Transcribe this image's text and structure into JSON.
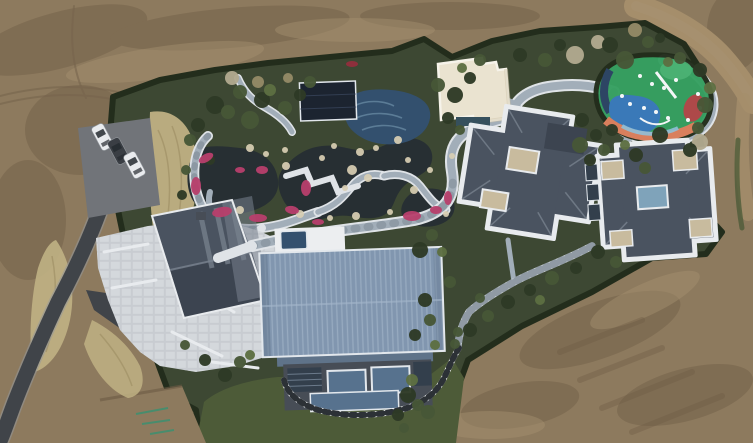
{
  "scene": {
    "kind": "aerial-drone-photo",
    "description": "Top-down aerial view of a landscaped private estate under construction: bare earth surrounds a hedged garden compound containing a koi pond garden with winding stone paths and pink azalea beds, a dark glass pavilion, a cream flat-roof pavilion, a colorful children's playground, two slate hip-roof villas with white parapets, a large blue standing-seam roof hall, a stone plaza with a gable-roof guest house, a parking pad with three cars and a curving asphalt road.",
    "objects": [
      "dirt ground",
      "dirt road",
      "hedge boundary",
      "garden grounds",
      "dry grass",
      "asphalt road",
      "parking pad",
      "3 cars",
      "stone plaza",
      "guest house",
      "pond",
      "flower beds",
      "rocks",
      "garden paths",
      "dark pavilion",
      "mosaic pool",
      "spa pool",
      "cream pavilion",
      "playground",
      "villa east",
      "villa far-east",
      "blue roof hall",
      "skylights",
      "checker path",
      "lawn",
      "shrubs",
      "bare trees"
    ]
  },
  "palette": {
    "dirt_base": "#8d7a5e",
    "dirt_dark": "#6d5a44",
    "dirt_light": "#a69270",
    "dirt_road": "#a58e6b",
    "dirt_track": "#77654e",
    "grass_dry": "#c0b184",
    "grass_dry_dark": "#9c8d62",
    "garden_base": "#3d4833",
    "hedge": "#232d1c",
    "lawn": "#4d5b38",
    "shrub_dark": "#2e3a26",
    "shrub_mid": "#475737",
    "shrub_light": "#5d6f42",
    "shrub_tan": "#948a67",
    "tree_bare": "#b1a98f",
    "water_dark": "#272f33",
    "pool_tile": "#33506e",
    "pool_wave": "#7da0b8",
    "path_light": "#dfe3e7",
    "path_mid": "#a2aeb9",
    "path_joint": "#76828d",
    "plaza": "#c8ccd1",
    "plaza_tile": "#eceef0",
    "rock": "#d9cfb4",
    "flower_pink": "#b83f6c",
    "flower_red": "#8e2f3c",
    "road_asphalt": "#404449",
    "road_edge": "#93989d",
    "parking": "#717479",
    "car_white": "#e9ebee",
    "car_dark": "#3a3e44",
    "car_glass": "#262b30",
    "roof_blue": "#8196af",
    "roof_blue_light": "#a3b5c9",
    "roof_blue_dark": "#5f7389",
    "wall_dark": "#474d56",
    "glass_blue": "#57728e",
    "glass_dark": "#333f4c",
    "glass_frame": "#e2e7ec",
    "roof_slate": "#4a5360",
    "roof_slate_dark": "#3c4450",
    "roof_slate_light": "#78828e",
    "parapet_white": "#e8ebee",
    "pad_tan": "#c8bb9e",
    "skylight": "#7fa3ba",
    "cream_roof": "#eae3d0",
    "cream_trim": "#f6f3ea",
    "cream_pool": "#36505d",
    "pavilion_dark": "#1c2430",
    "pavilion_line": "#38455b",
    "pg_green": "#36a061",
    "pg_green_light": "#4cb274",
    "pg_blue": "#3a79b8",
    "pg_orange": "#d97f5d",
    "pg_red": "#ae4949",
    "pg_navy": "#2d4564",
    "pg_light": "#8fc0d8",
    "white": "#f4f6f7",
    "spray_green": "#3d9070",
    "checker_dark": "#2c3136",
    "steps_light": "#ccd3d9"
  },
  "features": {
    "shrubs": [
      [
        215,
        105,
        9,
        "shrub_dark"
      ],
      [
        240,
        92,
        7,
        "shrub_mid"
      ],
      [
        262,
        100,
        8,
        "shrub_dark"
      ],
      [
        198,
        125,
        7,
        "shrub_dark"
      ],
      [
        228,
        112,
        7,
        "shrub_mid"
      ],
      [
        250,
        120,
        9,
        "shrub_mid"
      ],
      [
        285,
        108,
        7,
        "shrub_mid"
      ],
      [
        300,
        95,
        6,
        "shrub_dark"
      ],
      [
        310,
        82,
        6,
        "shrub_mid"
      ],
      [
        270,
        90,
        6,
        "shrub_light"
      ],
      [
        232,
        78,
        7,
        "tree_bare"
      ],
      [
        258,
        82,
        6,
        "shrub_tan"
      ],
      [
        288,
        78,
        5,
        "shrub_tan"
      ],
      [
        190,
        140,
        6,
        "shrub_mid"
      ],
      [
        210,
        160,
        5,
        "shrub_dark"
      ],
      [
        438,
        85,
        7,
        "shrub_mid"
      ],
      [
        455,
        95,
        8,
        "shrub_dark"
      ],
      [
        470,
        78,
        6,
        "shrub_dark"
      ],
      [
        462,
        68,
        5,
        "shrub_light"
      ],
      [
        480,
        60,
        6,
        "shrub_mid"
      ],
      [
        520,
        55,
        7,
        "shrub_dark"
      ],
      [
        545,
        60,
        7,
        "shrub_mid"
      ],
      [
        560,
        45,
        6,
        "shrub_dark"
      ],
      [
        575,
        55,
        9,
        "tree_bare"
      ],
      [
        598,
        42,
        7,
        "tree_bare"
      ],
      [
        610,
        45,
        8,
        "shrub_dark"
      ],
      [
        625,
        60,
        9,
        "shrub_mid"
      ],
      [
        635,
        30,
        7,
        "shrub_tan"
      ],
      [
        648,
        42,
        6,
        "shrub_mid"
      ],
      [
        660,
        38,
        5,
        "shrub_dark"
      ],
      [
        700,
        70,
        7,
        "shrub_dark"
      ],
      [
        705,
        105,
        8,
        "shrub_mid"
      ],
      [
        698,
        128,
        6,
        "shrub_mid"
      ],
      [
        710,
        88,
        6,
        "shrub_light"
      ],
      [
        700,
        142,
        8,
        "tree_bare"
      ],
      [
        680,
        58,
        6,
        "shrub_mid"
      ],
      [
        668,
        62,
        5,
        "shrub_light"
      ],
      [
        448,
        118,
        6,
        "shrub_dark"
      ],
      [
        460,
        130,
        5,
        "shrub_mid"
      ],
      [
        582,
        120,
        7,
        "shrub_dark"
      ],
      [
        596,
        135,
        6,
        "shrub_dark"
      ],
      [
        580,
        145,
        8,
        "shrub_mid"
      ],
      [
        604,
        150,
        6,
        "shrub_mid"
      ],
      [
        590,
        160,
        6,
        "shrub_dark"
      ],
      [
        612,
        130,
        6,
        "shrub_dark"
      ],
      [
        625,
        145,
        5,
        "shrub_light"
      ],
      [
        636,
        155,
        7,
        "shrub_dark"
      ],
      [
        660,
        135,
        8,
        "shrub_dark"
      ],
      [
        690,
        150,
        7,
        "shrub_dark"
      ],
      [
        645,
        168,
        6,
        "shrub_mid"
      ],
      [
        598,
        252,
        7,
        "shrub_dark"
      ],
      [
        616,
        262,
        6,
        "shrub_mid"
      ],
      [
        576,
        268,
        6,
        "shrub_dark"
      ],
      [
        552,
        278,
        7,
        "shrub_mid"
      ],
      [
        530,
        290,
        6,
        "shrub_dark"
      ],
      [
        508,
        302,
        7,
        "shrub_dark"
      ],
      [
        540,
        300,
        5,
        "shrub_light"
      ],
      [
        488,
        316,
        6,
        "shrub_mid"
      ],
      [
        470,
        330,
        7,
        "shrub_dark"
      ],
      [
        455,
        344,
        5,
        "shrub_mid"
      ],
      [
        480,
        298,
        5,
        "shrub_mid"
      ],
      [
        420,
        250,
        8,
        "shrub_dark"
      ],
      [
        432,
        235,
        6,
        "shrub_mid"
      ],
      [
        442,
        252,
        5,
        "shrub_light"
      ],
      [
        450,
        282,
        6,
        "shrub_mid"
      ],
      [
        425,
        300,
        7,
        "shrub_dark"
      ],
      [
        430,
        320,
        6,
        "shrub_mid"
      ],
      [
        415,
        335,
        6,
        "shrub_dark"
      ],
      [
        435,
        345,
        5,
        "shrub_light"
      ],
      [
        458,
        332,
        5,
        "shrub_mid"
      ],
      [
        225,
        375,
        7,
        "shrub_dark"
      ],
      [
        240,
        362,
        6,
        "shrub_mid"
      ],
      [
        205,
        360,
        6,
        "shrub_dark"
      ],
      [
        250,
        355,
        5,
        "shrub_light"
      ],
      [
        185,
        345,
        5,
        "shrub_mid"
      ],
      [
        408,
        395,
        8,
        "shrub_dark"
      ],
      [
        418,
        405,
        6,
        "shrub_mid"
      ],
      [
        398,
        415,
        6,
        "shrub_dark"
      ],
      [
        428,
        412,
        7,
        "shrub_mid"
      ],
      [
        412,
        380,
        6,
        "shrub_light"
      ],
      [
        404,
        428,
        5,
        "shrub_mid"
      ],
      [
        186,
        170,
        5,
        "shrub_mid"
      ],
      [
        182,
        195,
        5,
        "shrub_dark"
      ]
    ],
    "rocks": [
      [
        250,
        148,
        4
      ],
      [
        266,
        154,
        3
      ],
      [
        286,
        166,
        4
      ],
      [
        334,
        146,
        3
      ],
      [
        360,
        152,
        4
      ],
      [
        376,
        148,
        3
      ],
      [
        398,
        140,
        4
      ],
      [
        300,
        214,
        4
      ],
      [
        330,
        218,
        3
      ],
      [
        356,
        216,
        4
      ],
      [
        390,
        212,
        3
      ],
      [
        414,
        190,
        4
      ],
      [
        446,
        214,
        3
      ],
      [
        240,
        210,
        4
      ],
      [
        352,
        170,
        5
      ],
      [
        368,
        178,
        4
      ],
      [
        345,
        188,
        3
      ],
      [
        322,
        158,
        3
      ],
      [
        408,
        160,
        3
      ],
      [
        430,
        170,
        3
      ],
      [
        452,
        156,
        3
      ],
      [
        285,
        150,
        3
      ]
    ],
    "flowers": [
      [
        206,
        158,
        8,
        4,
        -30
      ],
      [
        196,
        186,
        5,
        9,
        0
      ],
      [
        222,
        212,
        10,
        5,
        -10
      ],
      [
        258,
        218,
        9,
        4,
        0
      ],
      [
        292,
        210,
        7,
        4,
        10
      ],
      [
        306,
        188,
        5,
        8,
        0
      ],
      [
        262,
        170,
        6,
        4,
        0
      ],
      [
        412,
        216,
        9,
        5,
        0
      ],
      [
        436,
        210,
        6,
        4,
        0
      ],
      [
        448,
        198,
        4,
        7,
        0
      ],
      [
        240,
        170,
        5,
        3,
        0
      ],
      [
        318,
        222,
        6,
        3,
        0
      ]
    ],
    "red_flowers": [
      [
        352,
        64,
        6,
        3,
        0
      ]
    ],
    "playground_dots": [
      [
        640,
        76
      ],
      [
        652,
        84
      ],
      [
        664,
        88
      ],
      [
        630,
        104
      ],
      [
        644,
        108
      ],
      [
        656,
        112
      ],
      [
        700,
        108
      ],
      [
        698,
        94
      ],
      [
        622,
        96
      ],
      [
        668,
        118
      ],
      [
        676,
        80
      ],
      [
        688,
        120
      ]
    ],
    "cars": [
      {
        "x": 96,
        "y": 124,
        "rot": -28,
        "tone": "car_white"
      },
      {
        "x": 112,
        "y": 138,
        "rot": -28,
        "tone": "car_dark"
      },
      {
        "x": 128,
        "y": 152,
        "rot": -28,
        "tone": "car_white"
      }
    ]
  }
}
